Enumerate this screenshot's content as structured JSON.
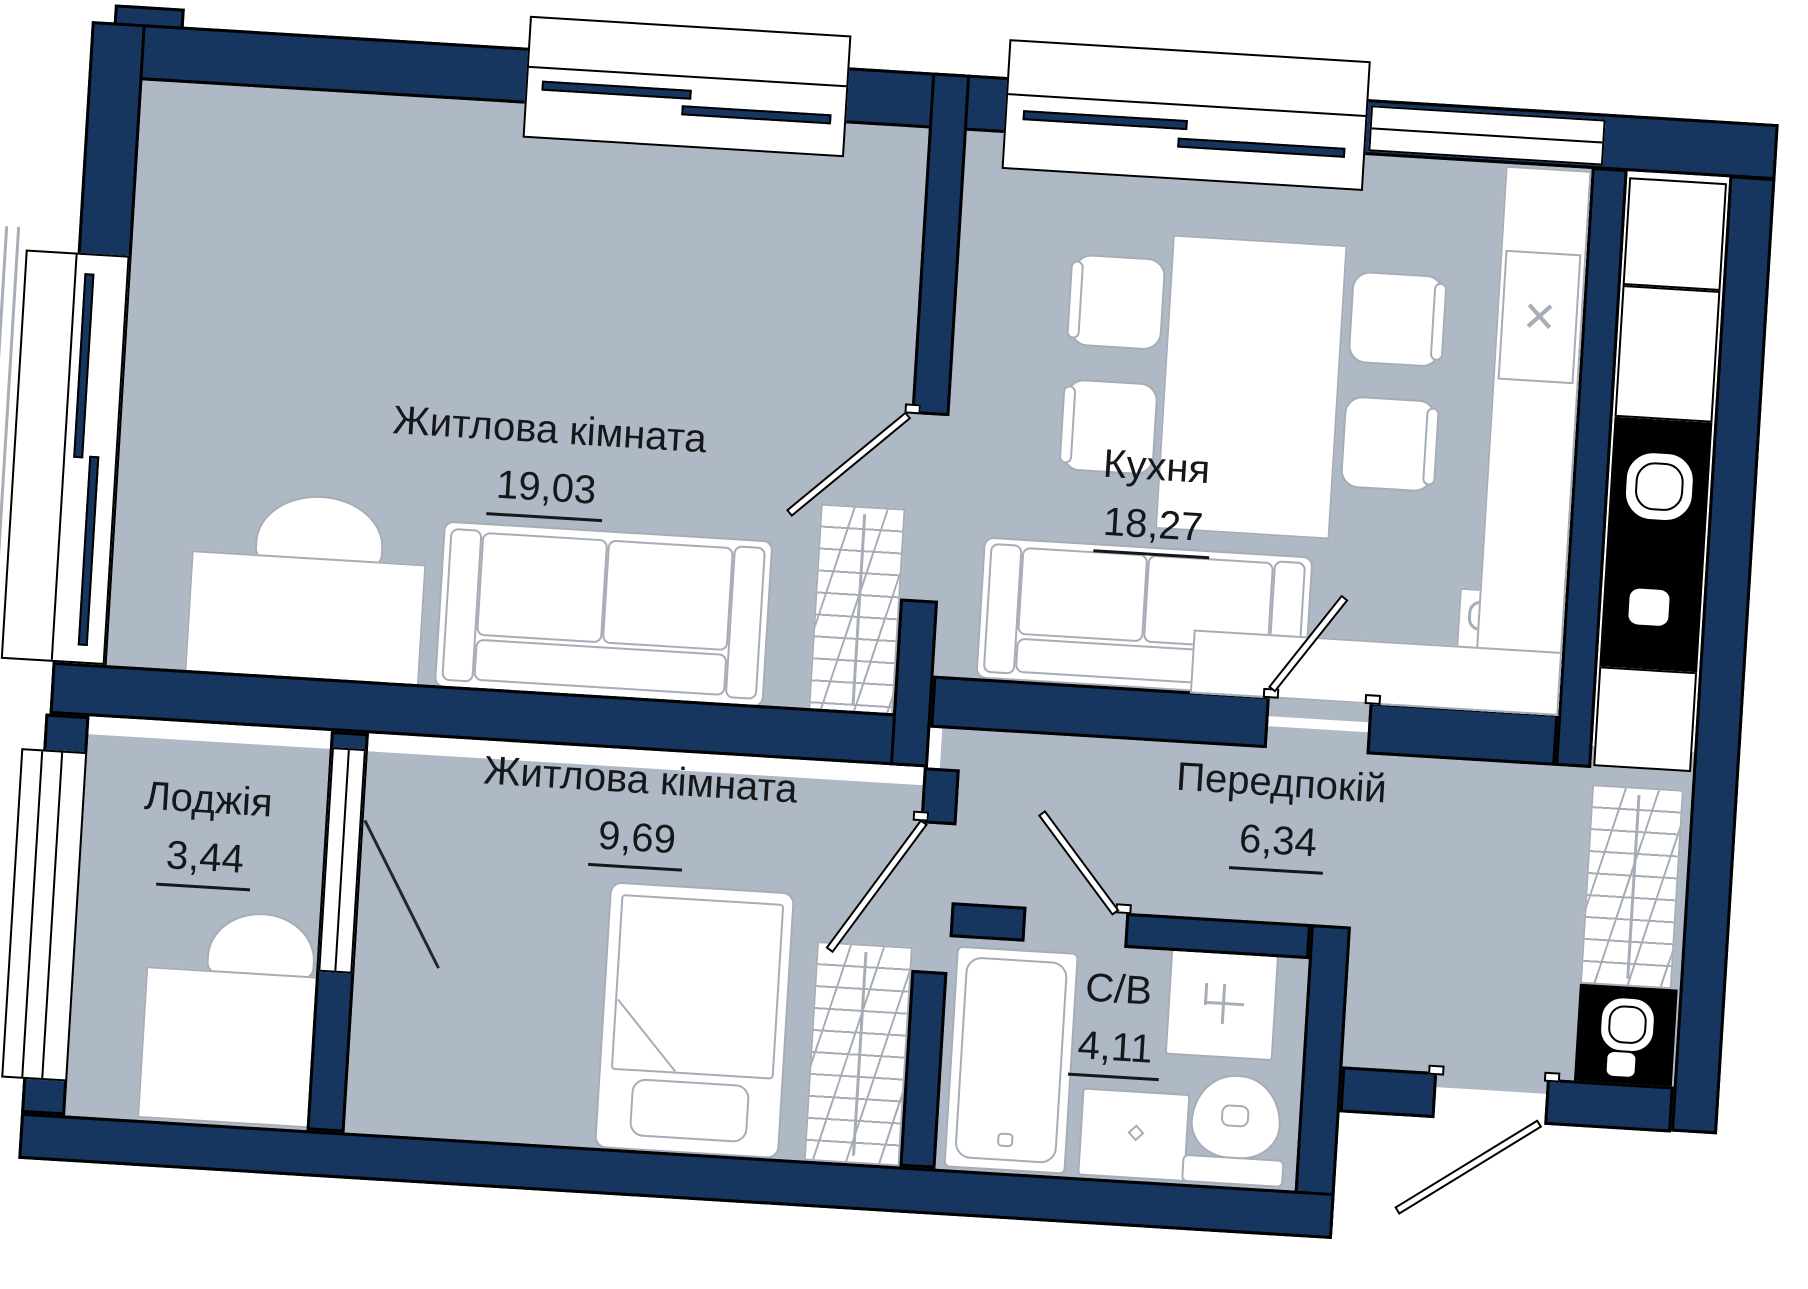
{
  "plan": {
    "rooms": {
      "living1": {
        "name": "Житлова кімната",
        "area": "19,03"
      },
      "kitchen": {
        "name": "Кухня",
        "area": "18,27"
      },
      "living2": {
        "name": "Житлова кімната",
        "area": "9,69"
      },
      "loggia": {
        "name": "Лоджія",
        "area": "3,44"
      },
      "hallway": {
        "name": "Передпокій",
        "area": "6,34"
      },
      "bathroom": {
        "name": "С/В",
        "area": "4,11"
      }
    },
    "icons": {
      "vent_x": "✕"
    },
    "colors": {
      "wall": "#16365f",
      "floor": "#afb8c5",
      "outline": "#000000",
      "furniture_stroke": "#a7adb6",
      "label_text": "#15171a"
    }
  }
}
